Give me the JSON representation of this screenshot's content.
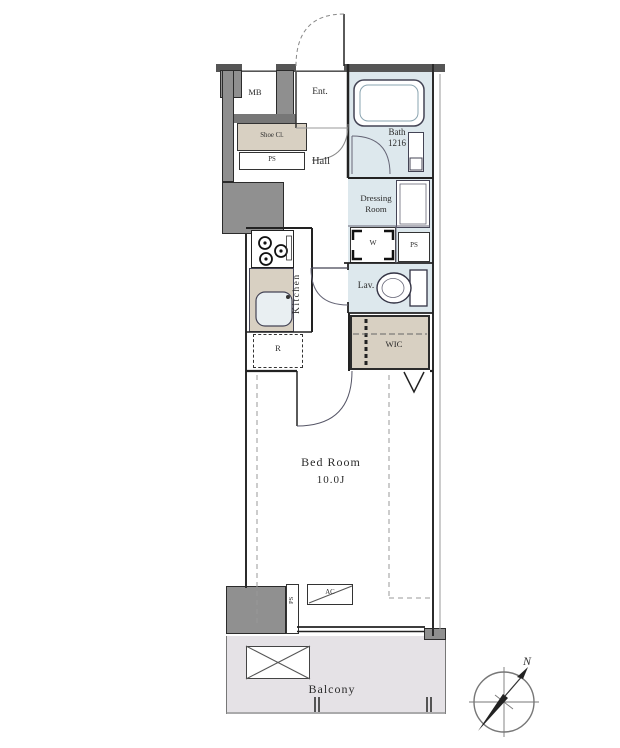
{
  "labels": {
    "mb": "MB",
    "entrance": "Ent.",
    "shoe_closet": "Shoe Cl.",
    "ps_entrance": "PS",
    "hall": "Hall",
    "bath": "Bath",
    "bath_size": "1216",
    "dressing_room_line1": "Dressing",
    "dressing_room_line2": "Room",
    "washer": "W",
    "ps_dressing": "PS",
    "lavatory": "Lav.",
    "kitchen": "Kitchen",
    "refrigerator": "R",
    "wic": "WIC",
    "bedroom": "Bed Room",
    "bedroom_size": "10.0J",
    "ac": "AC",
    "ps_bedroom": "PS",
    "balcony": "Balcony",
    "north": "N"
  },
  "colors": {
    "wet_area": "#dde8ed",
    "closet_beige": "#d8d0c2",
    "balcony_gray": "#e5e2e6",
    "wall_gray": "#8f8f8f",
    "wall_dark": "#555555",
    "line": "#2b2b2b"
  }
}
